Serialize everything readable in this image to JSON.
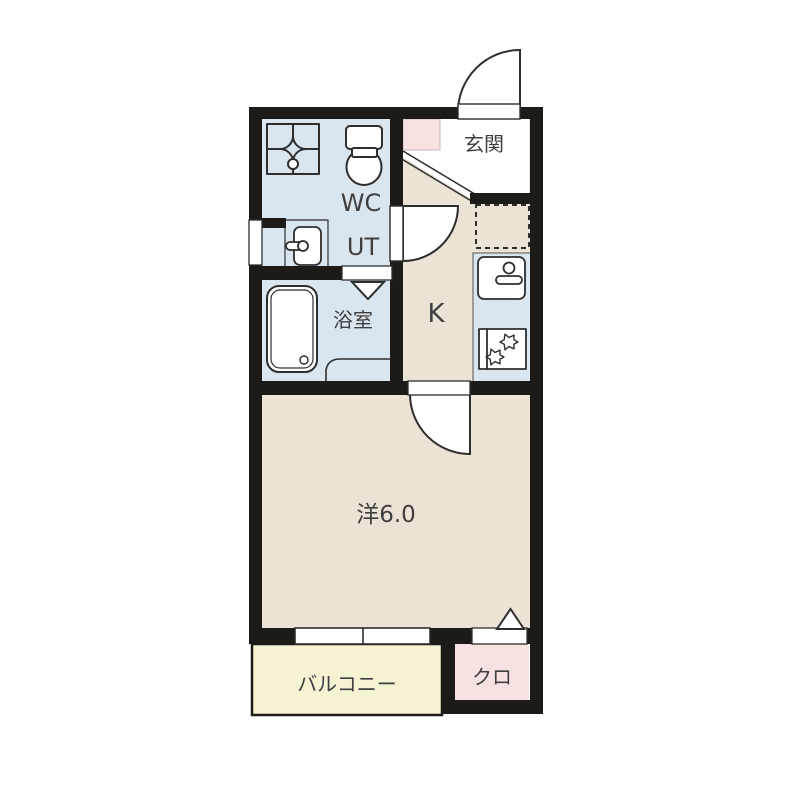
{
  "title": "1K apartment floor plan",
  "colors": {
    "wall": "#1d1b18",
    "wet_room": "#dae6ef",
    "living": "#ece3d7",
    "balcony": "#f5f3d3",
    "closet_pink": "#f8e1e1",
    "floor_white": "#ffffff",
    "line": "#2e2e2e",
    "text": "#3f3f3f"
  },
  "rooms": {
    "entrance": {
      "label": "玄関"
    },
    "wc": {
      "label": "WC"
    },
    "utility": {
      "label": "UT"
    },
    "bathroom": {
      "label": "浴室"
    },
    "kitchen": {
      "label": "K"
    },
    "western_room": {
      "label": "洋6.0"
    },
    "balcony": {
      "label": "バルコニー"
    },
    "closet": {
      "label": "クロ"
    }
  }
}
